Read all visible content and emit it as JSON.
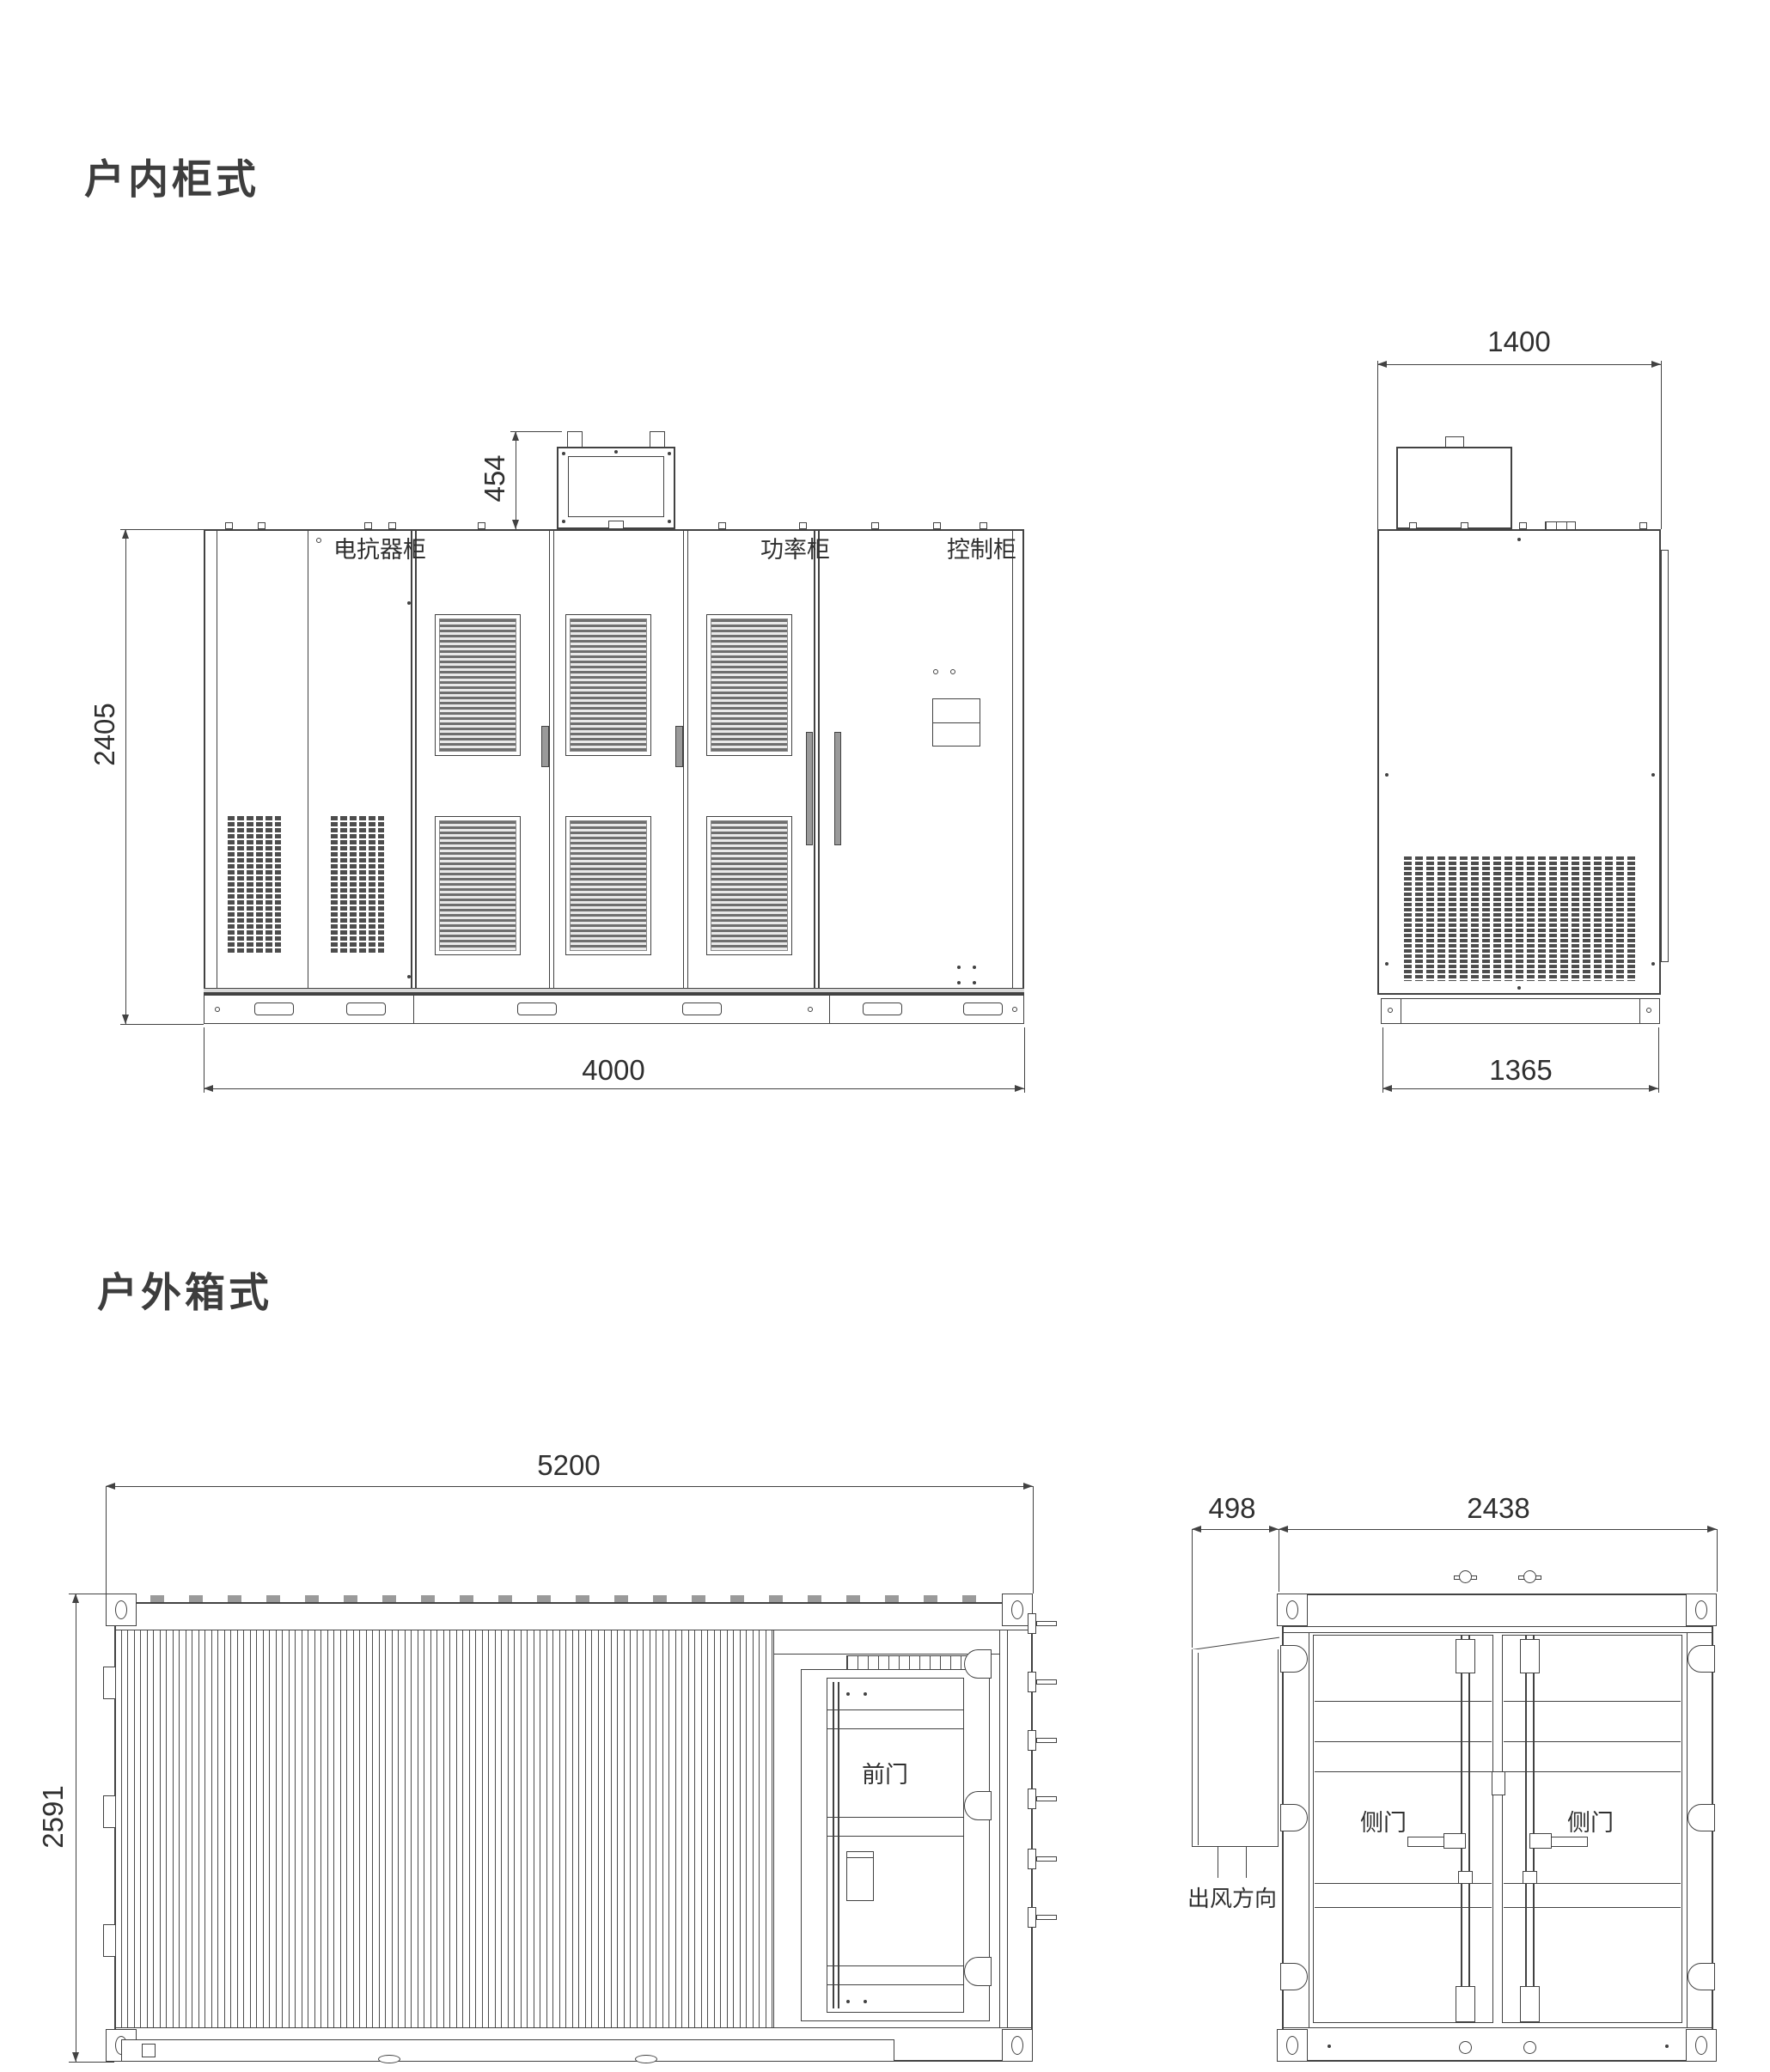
{
  "page": {
    "background": "#ffffff",
    "line_color": "#424242"
  },
  "sections": {
    "indoor": {
      "title": "户内柜式",
      "front_view": {
        "cabinet_labels": {
          "reactor": "电抗器柜",
          "power": "功率柜",
          "control": "控制柜"
        },
        "dims": {
          "height": "2405",
          "duct_height": "454",
          "width": "4000"
        }
      },
      "side_view": {
        "dims": {
          "top_width": "1400",
          "base_width": "1365"
        }
      }
    },
    "outdoor": {
      "title": "户外箱式",
      "side_view": {
        "door_label": "前门",
        "dims": {
          "length": "5200",
          "height": "2591"
        }
      },
      "end_view": {
        "door_labels": [
          "侧门",
          "侧门"
        ],
        "air_flow_label": "出风方向",
        "dims": {
          "duct_depth": "498",
          "width": "2438"
        }
      }
    }
  }
}
